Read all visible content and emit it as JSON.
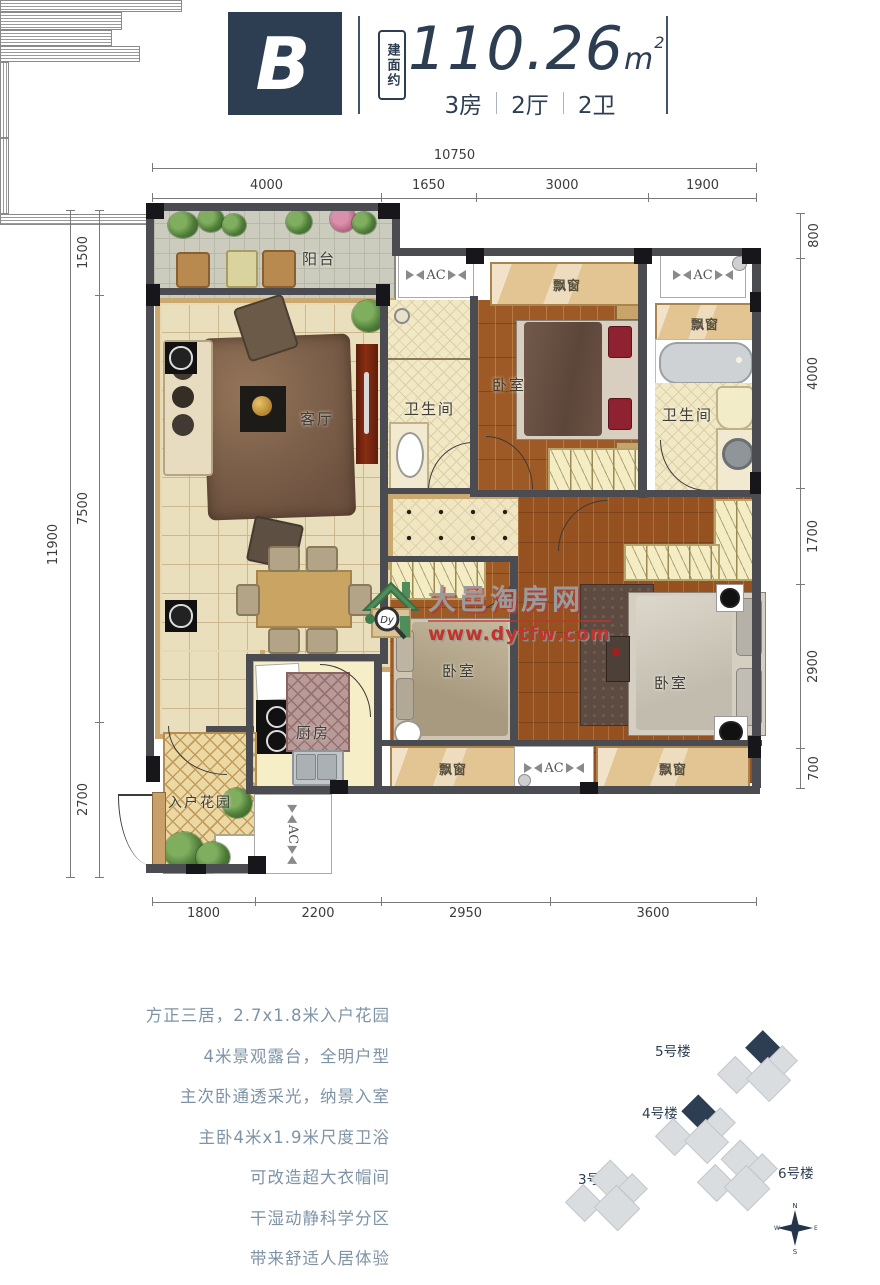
{
  "header": {
    "unit_label": "B",
    "area_prefix": "建面约",
    "area_value": "110.26",
    "area_unit": "m",
    "area_exponent": "2",
    "layout_parts": [
      "3房",
      "2厅",
      "2卫"
    ]
  },
  "dimensions": {
    "top_total": "10750",
    "top_segments": [
      "4000",
      "1650",
      "3000",
      "1900"
    ],
    "left_total": "11900",
    "left_segments": [
      "1500",
      "7500",
      "2700"
    ],
    "right_segments": [
      "800",
      "4000",
      "1700",
      "2900",
      "700"
    ],
    "bottom_segments": [
      "1800",
      "2200",
      "2950",
      "3600"
    ]
  },
  "rooms": {
    "balcony": "阳台",
    "living": "客厅",
    "bath1": "卫生间",
    "bath2": "卫生间",
    "bed1": "卧室",
    "bed2": "卧室",
    "bed3": "卧室",
    "kitchen": "厨房",
    "entry_garden": "入户花园",
    "bay1": "飘窗",
    "bay2": "飘窗",
    "bay3": "飘窗",
    "bay4": "飘窗",
    "ac": "AC"
  },
  "watermark": {
    "site_name": "大邑淘房网",
    "site_url": "www.dytfw.com",
    "logo_text": "Dy"
  },
  "features": [
    "方正三居，2.7x1.8米入户花园",
    "4米景观露台，全明户型",
    "主次卧通透采光，纳景入室",
    "主卧4米x1.9米尺度卫浴",
    "可改造超大衣帽间",
    "干湿动静科学分区",
    "带来舒适人居体验"
  ],
  "siteplan": {
    "buildings": [
      {
        "name": "5号楼"
      },
      {
        "name": "4号楼"
      },
      {
        "name": "3号楼"
      },
      {
        "name": "6号楼"
      }
    ],
    "compass": {
      "n": "N",
      "s": "S",
      "e": "E",
      "w": "W"
    }
  }
}
